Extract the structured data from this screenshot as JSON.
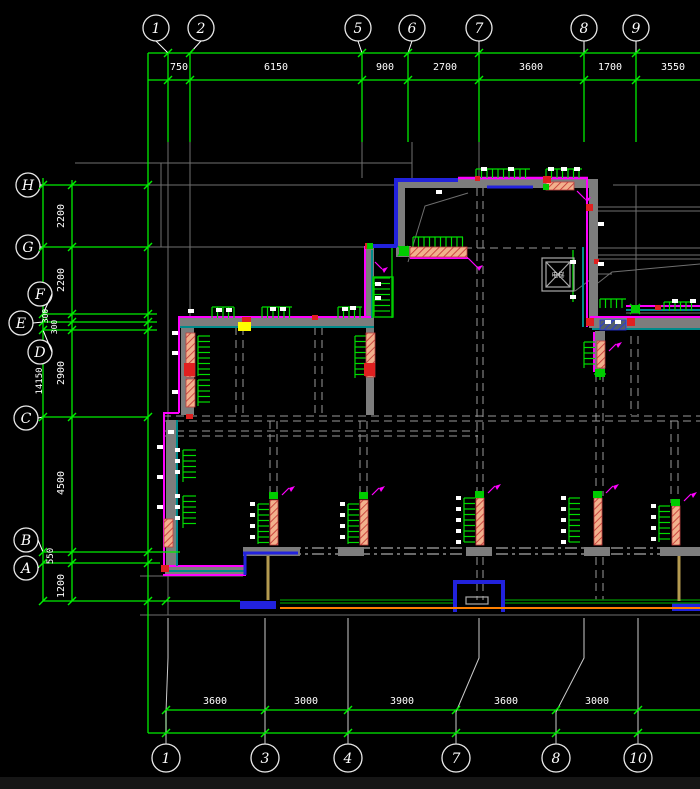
{
  "colors": {
    "background": "#000000",
    "dim_green": "#00ee00",
    "grid_gray": "#6f6f6f",
    "wall_gray": "#7d7d7d",
    "magenta": "#ff00ff",
    "blue": "#2222dd",
    "teal": "#008b8b",
    "red": "#e02020",
    "yellow": "#ffff00",
    "orange": "#ff8000",
    "tan": "#b49a50",
    "salmon": "#f2b08c",
    "white": "#ffffff",
    "dark_green": "#007a00"
  },
  "axes": {
    "top": {
      "bubbles": [
        {
          "label": "1",
          "cx": 156,
          "gx": 168
        },
        {
          "label": "2",
          "cx": 201,
          "gx": 190
        },
        {
          "label": "5",
          "cx": 358,
          "gx": 362
        },
        {
          "label": "6",
          "cx": 412,
          "gx": 408
        },
        {
          "label": "7",
          "cx": 479,
          "gx": 479
        },
        {
          "label": "8",
          "cx": 584,
          "gx": 584
        },
        {
          "label": "9",
          "cx": 636,
          "gx": 636
        }
      ],
      "dims": [
        {
          "v": "750",
          "x": 179
        },
        {
          "v": "6150",
          "x": 276
        },
        {
          "v": "900",
          "x": 385
        },
        {
          "v": "2700",
          "x": 445
        },
        {
          "v": "3600",
          "x": 531
        },
        {
          "v": "1700",
          "x": 610
        },
        {
          "v": "3550",
          "x": 673
        }
      ]
    },
    "bottom": {
      "bubbles": [
        {
          "label": "1",
          "cx": 166,
          "gx": 168
        },
        {
          "label": "3",
          "cx": 265,
          "gx": 265
        },
        {
          "label": "4",
          "cx": 348,
          "gx": 348
        },
        {
          "label": "7",
          "cx": 456,
          "gx": 479
        },
        {
          "label": "8",
          "cx": 556,
          "gx": 584
        },
        {
          "label": "10",
          "cx": 638,
          "gx": 638
        }
      ],
      "dims": [
        {
          "v": "3600",
          "x": 215
        },
        {
          "v": "3000",
          "x": 306
        },
        {
          "v": "3900",
          "x": 402
        },
        {
          "v": "3600",
          "x": 506
        },
        {
          "v": "3000",
          "x": 597
        }
      ]
    },
    "left": {
      "bubbles": [
        {
          "label": "H",
          "cx": 28,
          "cy": 185,
          "gy": 185,
          "x2": 148
        },
        {
          "label": "G",
          "cx": 28,
          "cy": 247,
          "gy": 247,
          "x2": 148
        },
        {
          "label": "F",
          "cx": 40,
          "cy": 294,
          "gy": 314,
          "x2": 157
        },
        {
          "label": "E",
          "cx": 21,
          "cy": 323,
          "gy": 322,
          "x2": 157
        },
        {
          "label": "D",
          "cx": 40,
          "cy": 352,
          "gy": 330,
          "x2": 157
        },
        {
          "label": "C",
          "cx": 26,
          "cy": 418,
          "gy": 417,
          "x2": 148
        },
        {
          "label": "B",
          "cx": 26,
          "cy": 540,
          "gy": 552,
          "x2": 180
        },
        {
          "label": "A",
          "cx": 26,
          "cy": 568,
          "gy": 563,
          "x2": 160
        }
      ],
      "dims": [
        {
          "v": "2200",
          "x": 64,
          "y": 216,
          "s": 10
        },
        {
          "v": "2200",
          "x": 64,
          "y": 280,
          "s": 10
        },
        {
          "v": "300",
          "x": 48,
          "y": 316,
          "s": 8
        },
        {
          "v": "300",
          "x": 57,
          "y": 327,
          "s": 8
        },
        {
          "v": "2900",
          "x": 64,
          "y": 373,
          "s": 10
        },
        {
          "v": "4500",
          "x": 64,
          "y": 483,
          "s": 10
        },
        {
          "v": "550",
          "x": 53,
          "y": 556,
          "s": 9
        },
        {
          "v": "1200",
          "x": 64,
          "y": 586,
          "s": 10
        }
      ],
      "overall": {
        "v": "14150",
        "x": 42,
        "y": 381,
        "s": 9
      }
    }
  },
  "plan": {
    "elevator_label": "电梯"
  },
  "marks": {
    "combs": [
      [
        413,
        237,
        50,
        10,
        "h",
        true
      ],
      [
        476,
        169,
        54,
        9,
        "h",
        true
      ],
      [
        546,
        169,
        36,
        9,
        "h",
        true
      ],
      [
        212,
        307,
        22,
        11,
        "h",
        false
      ],
      [
        262,
        307,
        30,
        11,
        "h",
        false
      ],
      [
        338,
        307,
        24,
        11,
        "h",
        false
      ],
      [
        600,
        299,
        26,
        9,
        "h",
        false
      ],
      [
        664,
        302,
        28,
        9,
        "h",
        false
      ],
      [
        198,
        336,
        40,
        12,
        "v",
        false
      ],
      [
        198,
        380,
        26,
        12,
        "v",
        false
      ],
      [
        355,
        336,
        42,
        11,
        "v",
        false
      ],
      [
        584,
        342,
        26,
        11,
        "v",
        false
      ],
      [
        183,
        450,
        32,
        13,
        "v",
        true
      ],
      [
        183,
        496,
        32,
        13,
        "v",
        true
      ],
      [
        258,
        504,
        40,
        11,
        "v",
        true
      ],
      [
        348,
        504,
        40,
        11,
        "v",
        true
      ],
      [
        464,
        498,
        44,
        11,
        "v",
        true
      ],
      [
        569,
        498,
        44,
        11,
        "v",
        true
      ],
      [
        659,
        506,
        36,
        11,
        "v",
        true
      ],
      [
        374,
        278,
        38,
        16,
        "v",
        false
      ]
    ],
    "salmon": [
      [
        410,
        247,
        57,
        10
      ],
      [
        546,
        182,
        28,
        8
      ],
      [
        186,
        333,
        9,
        44
      ],
      [
        186,
        379,
        9,
        28
      ],
      [
        366,
        333,
        9,
        44
      ],
      [
        164,
        519,
        9,
        28
      ],
      [
        270,
        500,
        8,
        45
      ],
      [
        360,
        500,
        8,
        45
      ],
      [
        476,
        498,
        8,
        47
      ],
      [
        594,
        498,
        8,
        47
      ],
      [
        672,
        506,
        8,
        39
      ],
      [
        597,
        341,
        8,
        27
      ]
    ],
    "bluehatch": [
      [
        600,
        320,
        26,
        10
      ]
    ],
    "reds": [
      [
        365,
        243,
        7,
        6
      ],
      [
        543,
        176,
        8,
        7
      ],
      [
        586,
        204,
        7,
        7
      ],
      [
        586,
        318,
        8,
        8
      ],
      [
        627,
        318,
        8,
        8
      ],
      [
        242,
        317,
        9,
        6
      ],
      [
        312,
        315,
        6,
        5
      ],
      [
        184,
        363,
        11,
        13
      ],
      [
        364,
        363,
        11,
        13
      ],
      [
        161,
        565,
        8,
        7
      ],
      [
        655,
        305,
        6,
        5
      ],
      [
        186,
        414,
        7,
        5
      ],
      [
        475,
        176,
        5,
        5
      ],
      [
        594,
        259,
        5,
        5
      ]
    ],
    "yellows": [
      [
        238,
        322,
        13,
        9
      ]
    ],
    "greensquares": [
      [
        269,
        492,
        9,
        7
      ],
      [
        359,
        492,
        9,
        7
      ],
      [
        475,
        491,
        9,
        7
      ],
      [
        593,
        491,
        9,
        7
      ],
      [
        671,
        499,
        9,
        7
      ],
      [
        399,
        246,
        10,
        10
      ],
      [
        631,
        305,
        9,
        8
      ],
      [
        595,
        369,
        10,
        8
      ],
      [
        543,
        184,
        6,
        6
      ],
      [
        367,
        243,
        6,
        6
      ]
    ],
    "flags": [
      [
        468,
        258,
        477,
        267
      ],
      [
        577,
        191,
        585,
        199
      ],
      [
        282,
        495,
        289,
        488
      ],
      [
        372,
        495,
        379,
        488
      ],
      [
        488,
        493,
        495,
        486
      ],
      [
        606,
        493,
        613,
        486
      ],
      [
        684,
        501,
        691,
        494
      ],
      [
        609,
        351,
        616,
        344
      ],
      [
        375,
        262,
        382,
        269
      ]
    ],
    "whiteticks": [
      [
        188,
        309
      ],
      [
        216,
        308
      ],
      [
        226,
        308
      ],
      [
        270,
        307
      ],
      [
        280,
        307
      ],
      [
        342,
        307
      ],
      [
        350,
        306
      ],
      [
        481,
        167
      ],
      [
        508,
        167
      ],
      [
        548,
        167
      ],
      [
        561,
        167
      ],
      [
        574,
        167
      ],
      [
        172,
        331
      ],
      [
        172,
        351
      ],
      [
        172,
        390
      ],
      [
        157,
        445
      ],
      [
        157,
        475
      ],
      [
        157,
        505
      ],
      [
        570,
        260
      ],
      [
        570,
        295
      ],
      [
        605,
        320
      ],
      [
        615,
        320
      ],
      [
        672,
        299
      ],
      [
        690,
        299
      ],
      [
        436,
        190
      ],
      [
        598,
        222
      ],
      [
        598,
        262
      ],
      [
        375,
        282
      ],
      [
        375,
        296
      ],
      [
        168,
        430
      ]
    ]
  }
}
